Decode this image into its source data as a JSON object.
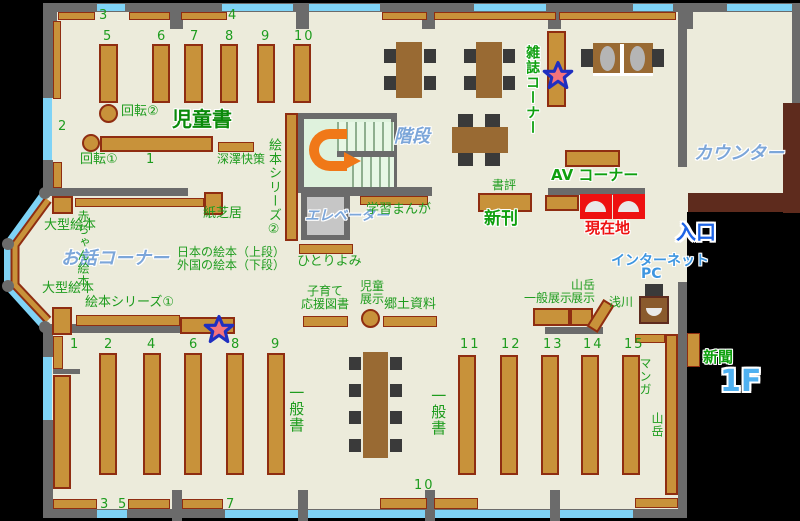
{
  "floor_label": "1F",
  "labels": {
    "jidosho": "児童書",
    "kaidan": "階段",
    "elevator": "エレベーター",
    "counter": "カウンター",
    "zasshi_corner": "雑誌コーナー",
    "av_corner": "AV コーナー",
    "shohyo": "書評",
    "shinkan": "新刊",
    "genzaichi": "現在地",
    "entrance": "入口",
    "internet": "インターネット",
    "pc": "PC",
    "shinbun": "新聞",
    "gakushu_manga": "学習まんが",
    "kamishibai": "紙芝居",
    "ogata_ehon_top": "大型絵本",
    "ogata_ehon_bottom": "大型絵本",
    "akachan_ehon": "赤ちゃん絵本",
    "ohanashi_corner": "お話コーナー",
    "ehon_series1": "絵本シリーズ①",
    "ehon_series2": "絵本シリーズ②",
    "kaiten1": "回転①",
    "kaiten2": "回転②",
    "fukazawa_kaisaku": "深澤快策",
    "hitoriyomi": "ひとりよみ",
    "nihon_ehon": "日本の絵本（上段）",
    "gaikoku_ehon": "外国の絵本（下段）",
    "kosodate_line1": "子育て",
    "kosodate_line2": "応援図書",
    "jido_tenji_line1": "児童",
    "jido_tenji_line2": "展示",
    "kyodo_shiryo": "郷土資料",
    "ippan_tenji": "一般展示",
    "sangaku_tenji_line1": "山岳",
    "sangaku_tenji_line2": "展示",
    "asakawa": "浅川",
    "ippansho_left": "一般書",
    "ippansho_right": "一般書",
    "manga": "マンガ",
    "sangaku": "山岳"
  },
  "numbers": {
    "children": {
      "n1": "1",
      "n2": "2",
      "n3": "3",
      "n4": "4",
      "n5": "5",
      "n6": "6",
      "n7": "7",
      "n8": "8",
      "n9": "9",
      "n10": "10"
    },
    "general": {
      "n1": "1",
      "n2": "2",
      "n3": "3",
      "n4": "4",
      "n5": "5",
      "n6": "6",
      "n7": "7",
      "n8": "8",
      "n9": "9",
      "n10": "10",
      "n11": "11",
      "n12": "12",
      "n13": "13",
      "n14": "14",
      "n15": "15"
    }
  },
  "colors": {
    "floor": "#ECEBDB",
    "wall": "#6B6B6B",
    "window": "#7FD3F6",
    "shelf": "#C8923A",
    "shelf_border": "#8F2D11",
    "counter": "#5E2B1D",
    "green_text": "#1E9C1E",
    "blue_italic_text": "#7CA6D9",
    "entrance_blue": "#1E64E6",
    "floor_level_blue": "#4FB0F0",
    "current_location_red": "#EE1111",
    "arrow_orange": "#F07818",
    "star_fill": "#F4737C",
    "star_border": "#1F2FC0"
  }
}
